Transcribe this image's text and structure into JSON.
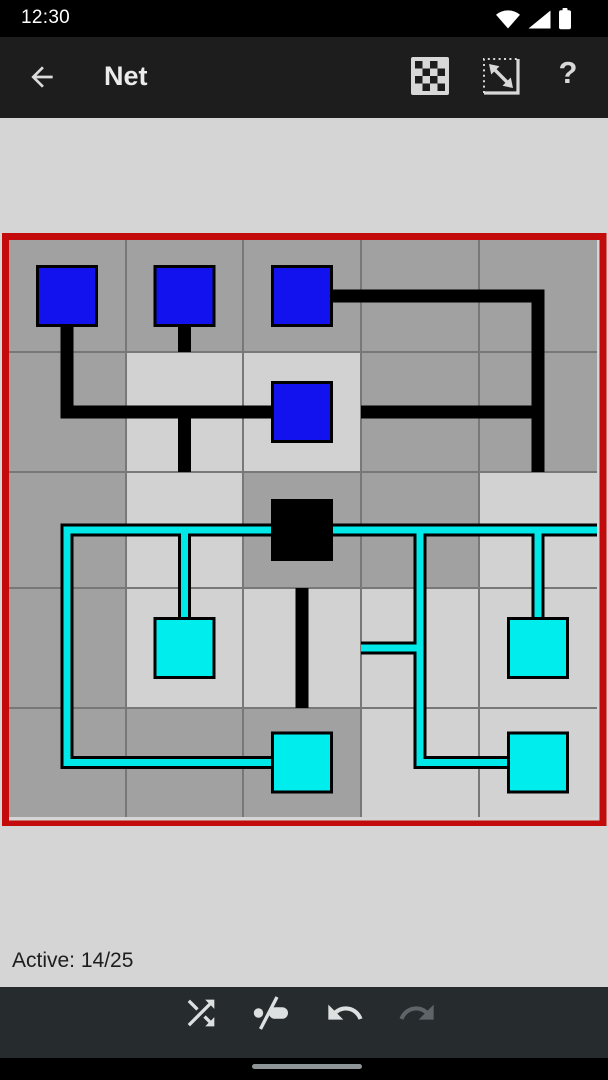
{
  "status_bar": {
    "time": "12:30",
    "icons": [
      "wifi",
      "cellular-signal",
      "battery"
    ]
  },
  "app_bar": {
    "title": "Net",
    "back_icon": "arrow-left",
    "actions": [
      {
        "id": "game-type",
        "icon": "checkerboard"
      },
      {
        "id": "resize",
        "icon": "resize-diagonal"
      },
      {
        "id": "help",
        "label": "?"
      }
    ]
  },
  "status_area": {
    "active_label": "Active: 14/25",
    "active_count": 14,
    "total_cells": 25
  },
  "toolbar": {
    "buttons": [
      {
        "id": "shuffle",
        "icon": "shuffle-arrows",
        "enabled": true
      },
      {
        "id": "mode-toggle",
        "icon": "dot-slash-pill",
        "enabled": true
      },
      {
        "id": "undo",
        "icon": "undo-arrow",
        "enabled": true
      },
      {
        "id": "redo",
        "icon": "redo-arrow",
        "enabled": false
      }
    ]
  },
  "nav_bar": {
    "home_indicator": true
  },
  "board": {
    "grid_cols": 5,
    "grid_rows": 5,
    "cols": [
      6,
      124,
      241,
      359,
      477,
      595
    ],
    "rows": [
      7,
      119,
      239,
      355,
      475,
      584
    ],
    "origin": {
      "left": 2,
      "top": 233
    },
    "svg_width": 605,
    "svg_height": 593,
    "border_width": 7,
    "wire_width": 13,
    "wire_core_width": 7,
    "node_size": 62,
    "colors": {
      "cell_dark": "#a1a1a1",
      "cell_light": "#d2d2d2",
      "grid_line": "#787878",
      "border": "#c40b0b",
      "wire_black": "#000000",
      "wire_cyan": "#00e8e8",
      "node_blue": "#1212ee",
      "node_cyan": "#00eded",
      "node_source": "#000000"
    },
    "cells": [
      {
        "c": 0,
        "r": 0,
        "shade": "dark",
        "wire": "black",
        "arms": "D",
        "node": "blue"
      },
      {
        "c": 1,
        "r": 0,
        "shade": "dark",
        "wire": "black",
        "arms": "D",
        "node": "blue"
      },
      {
        "c": 2,
        "r": 0,
        "shade": "dark",
        "wire": "black",
        "arms": "R",
        "node": "blue"
      },
      {
        "c": 3,
        "r": 0,
        "shade": "dark",
        "wire": "black",
        "arms": "LR",
        "node": null
      },
      {
        "c": 4,
        "r": 0,
        "shade": "dark",
        "wire": "black",
        "arms": "LD",
        "node": null
      },
      {
        "c": 0,
        "r": 1,
        "shade": "dark",
        "wire": "black",
        "arms": "UR",
        "node": null
      },
      {
        "c": 1,
        "r": 1,
        "shade": "light",
        "wire": "black",
        "arms": "LRD",
        "node": null
      },
      {
        "c": 2,
        "r": 1,
        "shade": "light",
        "wire": "black",
        "arms": "L",
        "node": "blue"
      },
      {
        "c": 3,
        "r": 1,
        "shade": "dark",
        "wire": "black",
        "arms": "LR",
        "node": null
      },
      {
        "c": 4,
        "r": 1,
        "shade": "dark",
        "wire": "black",
        "arms": "ULD",
        "node": null
      },
      {
        "c": 0,
        "r": 2,
        "shade": "dark",
        "wire": "cyan",
        "arms": "RD",
        "node": null
      },
      {
        "c": 1,
        "r": 2,
        "shade": "light",
        "wire": "cyan",
        "arms": "LRD",
        "node": null
      },
      {
        "c": 2,
        "r": 2,
        "shade": "dark",
        "wire": "cyan",
        "arms": "LR",
        "node": "source"
      },
      {
        "c": 3,
        "r": 2,
        "shade": "dark",
        "wire": "cyan",
        "arms": "LRD",
        "node": null
      },
      {
        "c": 4,
        "r": 2,
        "shade": "light",
        "wire": "cyan",
        "arms": "LRD",
        "node": null
      },
      {
        "c": 0,
        "r": 3,
        "shade": "dark",
        "wire": "cyan",
        "arms": "UD",
        "node": null
      },
      {
        "c": 1,
        "r": 3,
        "shade": "light",
        "wire": "cyan",
        "arms": "U",
        "node": "cyan"
      },
      {
        "c": 2,
        "r": 3,
        "shade": "light",
        "wire": "black",
        "arms": "UD",
        "node": null
      },
      {
        "c": 3,
        "r": 3,
        "shade": "light",
        "wire": "cyan",
        "arms": "ULD",
        "node": null
      },
      {
        "c": 4,
        "r": 3,
        "shade": "light",
        "wire": "cyan",
        "arms": "U",
        "node": "cyan"
      },
      {
        "c": 0,
        "r": 4,
        "shade": "dark",
        "wire": "cyan",
        "arms": "UR",
        "node": null
      },
      {
        "c": 1,
        "r": 4,
        "shade": "dark",
        "wire": "cyan",
        "arms": "LR",
        "node": null
      },
      {
        "c": 2,
        "r": 4,
        "shade": "dark",
        "wire": "cyan",
        "arms": "L",
        "node": "cyan"
      },
      {
        "c": 3,
        "r": 4,
        "shade": "light",
        "wire": "cyan",
        "arms": "UR",
        "node": null
      },
      {
        "c": 4,
        "r": 4,
        "shade": "light",
        "wire": "cyan",
        "arms": "L",
        "node": "cyan"
      }
    ]
  }
}
